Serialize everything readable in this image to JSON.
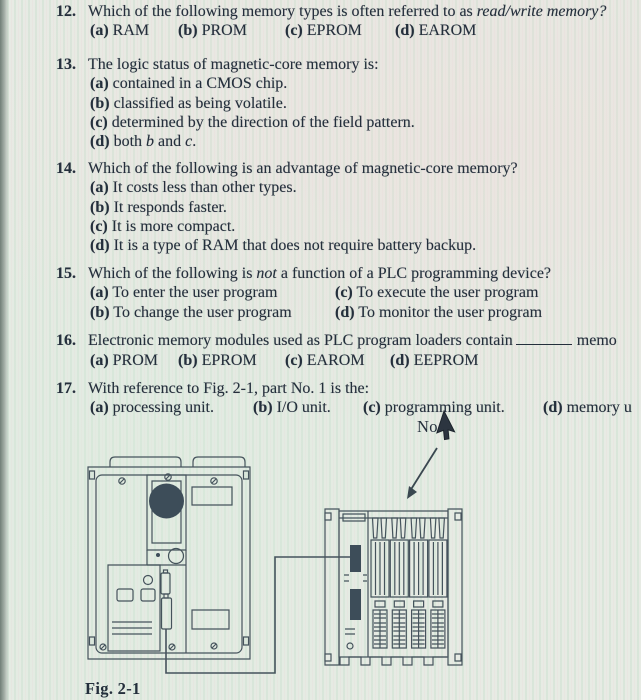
{
  "colors": {
    "ink": "#242f3c",
    "paper": "#e7ebe4",
    "figure_line": "#45535c",
    "figure_dark_fill": "#3d4d59"
  },
  "questions": [
    {
      "num": "12.",
      "pre": "Which of the following memory types is often referred to as ",
      "italic": "read/write memory?",
      "post": "",
      "options": [
        {
          "label": "(a)",
          "text": "RAM"
        },
        {
          "label": "(b)",
          "text": "PROM"
        },
        {
          "label": "(c)",
          "text": "EPROM"
        },
        {
          "label": "(d)",
          "text": "EAROM"
        }
      ]
    },
    {
      "num": "13.",
      "pre": "The logic status of magnetic-core memory is:",
      "italic": "",
      "post": "",
      "options": [
        {
          "label": "(a)",
          "text": "contained in a CMOS chip."
        },
        {
          "label": "(b)",
          "text": "classified as being volatile."
        },
        {
          "label": "(c)",
          "text": "determined by the direction of the field pattern."
        },
        {
          "label": "(d)",
          "pre": "both ",
          "i1": "b",
          "mid": " and ",
          "i2": "c",
          "post": "."
        }
      ]
    },
    {
      "num": "14.",
      "pre": "Which of the following is an advantage of magnetic-core memory?",
      "italic": "",
      "post": "",
      "options": [
        {
          "label": "(a)",
          "text": "It costs less than other types."
        },
        {
          "label": "(b)",
          "text": "It responds faster."
        },
        {
          "label": "(c)",
          "text": "It is more compact."
        },
        {
          "label": "(d)",
          "text": "It is a type of RAM that does not require battery backup."
        }
      ]
    },
    {
      "num": "15.",
      "pre": "Which of the following is ",
      "italic": "not",
      "post": " a function of a PLC programming device?",
      "options": [
        {
          "label": "(a)",
          "text": "To enter the user program"
        },
        {
          "label": "(b)",
          "text": "To change the user program"
        },
        {
          "label": "(c)",
          "text": "To execute the user program"
        },
        {
          "label": "(d)",
          "text": "To monitor the user program"
        }
      ]
    },
    {
      "num": "16.",
      "pre": "Electronic memory modules used as PLC program loaders contain",
      "tail": "memo",
      "options": [
        {
          "label": "(a)",
          "text": "PROM"
        },
        {
          "label": "(b)",
          "text": "EPROM"
        },
        {
          "label": "(c)",
          "text": "EAROM"
        },
        {
          "label": "(d)",
          "text": "EEPROM"
        }
      ]
    },
    {
      "num": "17.",
      "pre": "With reference to Fig. 2-1, part No. 1 is the:",
      "italic": "",
      "post": "",
      "options": [
        {
          "label": "(a)",
          "text": "processing unit."
        },
        {
          "label": "(b)",
          "text": "I/O unit."
        },
        {
          "label": "(c)",
          "text": "programming unit."
        },
        {
          "label": "(d)",
          "text": "memory u"
        }
      ]
    }
  ],
  "figure": {
    "pointer_label": "No.",
    "caption": "Fig. 2-1"
  }
}
